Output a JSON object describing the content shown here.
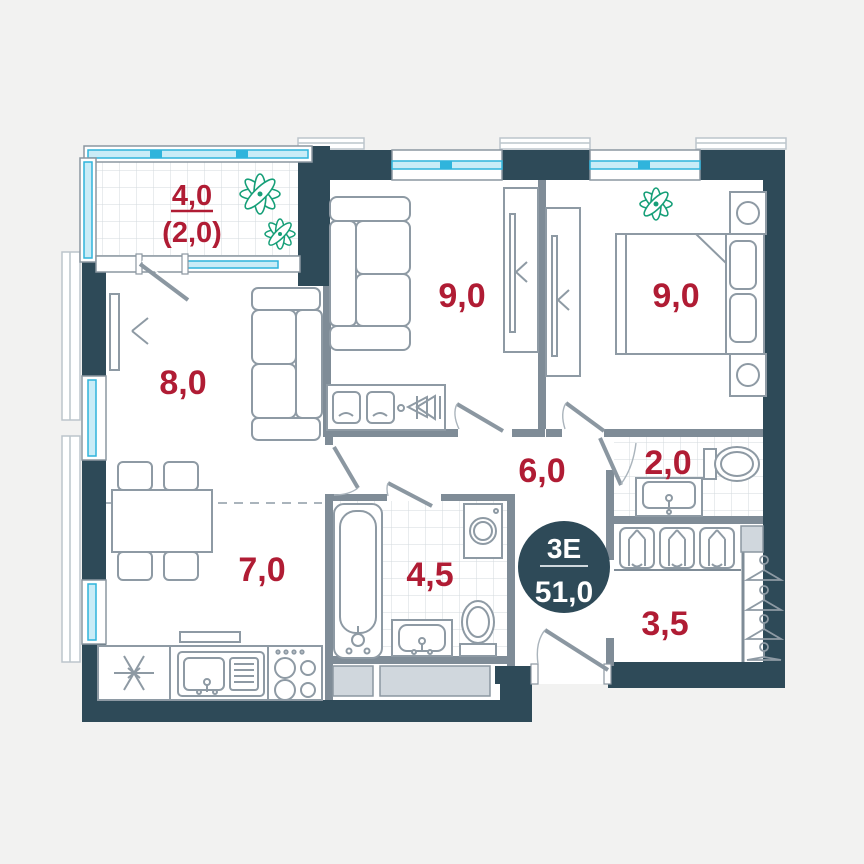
{
  "title": "apartment-floor-plan",
  "badge": {
    "type": "3Е",
    "total_area": "51,0"
  },
  "rooms": {
    "balcony": {
      "area": "4,0",
      "area_reduced": "(2,0)"
    },
    "living": {
      "area": "9,0"
    },
    "bedroom": {
      "area": "9,0"
    },
    "room": {
      "area": "8,0"
    },
    "kitchen": {
      "area": "7,0"
    },
    "hall": {
      "area": "6,0"
    },
    "wc": {
      "area": "2,0"
    },
    "bathroom": {
      "area": "4,5"
    },
    "wardrobe": {
      "area": "3,5"
    }
  },
  "colors": {
    "wall": "#2e4a58",
    "area_label": "#b01c34",
    "window": "#2fb4dc",
    "plant": "#169f78"
  }
}
